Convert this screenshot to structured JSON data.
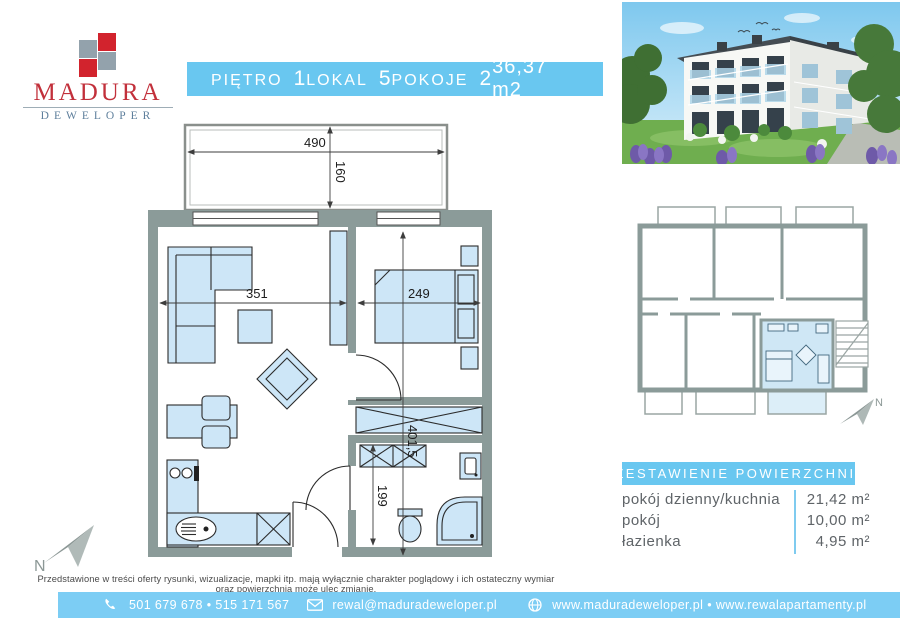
{
  "logo": {
    "brand": "MADURA",
    "subtitle": "DEWELOPER"
  },
  "header": {
    "floor_label": "PIĘTRO",
    "floor_value": "1",
    "unit_label": "LOKAL",
    "unit_value": "5",
    "rooms_label": "POKOJE",
    "rooms_value": "2",
    "area_value": "36,37 m2"
  },
  "floor_plan": {
    "dimensions": {
      "balcony_width": "490",
      "balcony_depth": "160",
      "living_width": "351",
      "bedroom_width": "249",
      "apartment_depth": "401,5",
      "hall_depth": "199"
    },
    "north_label": "N"
  },
  "overview_plan": {
    "north_label": "N"
  },
  "areas": {
    "title": "ZESTAWIENIE POWIERZCHNI:",
    "rows": [
      {
        "label": "pokój dzienny/kuchnia",
        "value": "21,42 m²"
      },
      {
        "label": "pokój",
        "value": "10,00 m²"
      },
      {
        "label": "łazienka",
        "value": "4,95 m²"
      }
    ]
  },
  "disclaimer": "Przedstawione w treści oferty rysunki, wizualizacje, mapki itp. mają wyłącznie charakter poglądowy i ich ostateczny wymiar oraz powierzchnia może ulec zmianie.",
  "footer": {
    "phone_icon": "phone",
    "phones": "501 679 678 • 515 171 567",
    "email_icon": "envelope",
    "email": "rewal@maduradeweloper.pl",
    "web_icon": "globe",
    "websites": "www.maduradeweloper.pl • www.rewalapartamenty.pl"
  },
  "colors": {
    "accent_blue": "#69c7f0",
    "footer_blue": "#7ccdf4",
    "wall_gray": "#8b9b99",
    "furniture_blue": "#cde6f7",
    "logo_red": "#c2303b",
    "logo_gray": "#5e7f9c"
  }
}
